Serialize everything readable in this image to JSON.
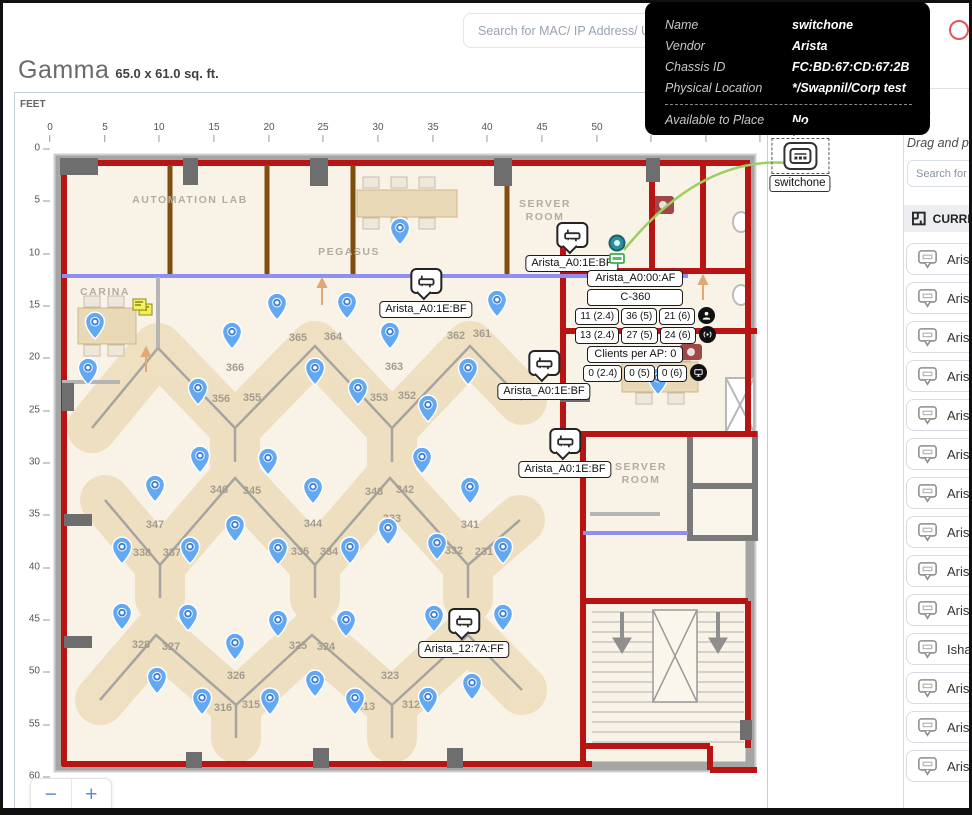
{
  "search": {
    "placeholder": "Search for MAC/ IP Address/ User"
  },
  "tooltip": {
    "rows": [
      {
        "label": "Name",
        "value": "switchone"
      },
      {
        "label": "Vendor",
        "value": "Arista"
      },
      {
        "label": "Chassis ID",
        "value": "FC:BD:67:CD:67:2B"
      },
      {
        "label": "Physical Location",
        "value": "*/Swapnil/Corp test"
      }
    ],
    "footer": {
      "label": "Available to Place",
      "value": "No"
    }
  },
  "header": {
    "title": "Gamma",
    "dimensions": "65.0 x 61.0 sq. ft."
  },
  "map": {
    "unit_label": "FEET",
    "zoom_out": "−",
    "zoom_in": "+",
    "x_ticks": [
      {
        "t": "0",
        "x": 50
      },
      {
        "t": "5",
        "x": 105
      },
      {
        "t": "10",
        "x": 159
      },
      {
        "t": "15",
        "x": 214
      },
      {
        "t": "20",
        "x": 269
      },
      {
        "t": "25",
        "x": 323
      },
      {
        "t": "30",
        "x": 378
      },
      {
        "t": "35",
        "x": 433
      },
      {
        "t": "40",
        "x": 487
      },
      {
        "t": "45",
        "x": 542
      },
      {
        "t": "50",
        "x": 597
      },
      {
        "t": "55",
        "x": 651
      },
      {
        "t": "60",
        "x": 706
      },
      {
        "t": "65",
        "x": 760
      }
    ],
    "y_ticks": [
      {
        "t": "0",
        "y": 148
      },
      {
        "t": "5",
        "y": 200
      },
      {
        "t": "10",
        "y": 253
      },
      {
        "t": "15",
        "y": 305
      },
      {
        "t": "20",
        "y": 357
      },
      {
        "t": "25",
        "y": 410
      },
      {
        "t": "30",
        "y": 462
      },
      {
        "t": "35",
        "y": 514
      },
      {
        "t": "40",
        "y": 567
      },
      {
        "t": "45",
        "y": 619
      },
      {
        "t": "50",
        "y": 671
      },
      {
        "t": "55",
        "y": 724
      },
      {
        "t": "60",
        "y": 776
      }
    ]
  },
  "floorplan": {
    "rooms": [
      {
        "name": "AUTOMATION LAB",
        "x": 190,
        "y": 200
      },
      {
        "name": "PEGASUS",
        "x": 349,
        "y": 252
      },
      {
        "name": "SERVER ROOM",
        "x": 545,
        "y": 211,
        "stack": true
      },
      {
        "name": "CARINA",
        "x": 105,
        "y": 292
      },
      {
        "name": "SERVER ROOM",
        "x": 641,
        "y": 474,
        "stack": true
      }
    ],
    "desks": [
      {
        "n": "365",
        "x": 298,
        "y": 338
      },
      {
        "n": "364",
        "x": 333,
        "y": 337
      },
      {
        "n": "366",
        "x": 235,
        "y": 368
      },
      {
        "n": "356",
        "x": 221,
        "y": 399
      },
      {
        "n": "355",
        "x": 252,
        "y": 398
      },
      {
        "n": "363",
        "x": 394,
        "y": 367
      },
      {
        "n": "353",
        "x": 379,
        "y": 398
      },
      {
        "n": "352",
        "x": 407,
        "y": 396
      },
      {
        "n": "362",
        "x": 456,
        "y": 336
      },
      {
        "n": "361",
        "x": 482,
        "y": 334
      },
      {
        "n": "346",
        "x": 219,
        "y": 490
      },
      {
        "n": "345",
        "x": 252,
        "y": 491
      },
      {
        "n": "347",
        "x": 155,
        "y": 525
      },
      {
        "n": "338",
        "x": 142,
        "y": 553
      },
      {
        "n": "337",
        "x": 172,
        "y": 553
      },
      {
        "n": "344",
        "x": 313,
        "y": 524
      },
      {
        "n": "335",
        "x": 300,
        "y": 552
      },
      {
        "n": "334",
        "x": 329,
        "y": 552
      },
      {
        "n": "343",
        "x": 374,
        "y": 492
      },
      {
        "n": "342",
        "x": 405,
        "y": 490
      },
      {
        "n": "333",
        "x": 392,
        "y": 519
      },
      {
        "n": "341",
        "x": 470,
        "y": 525
      },
      {
        "n": "332",
        "x": 454,
        "y": 551
      },
      {
        "n": "231",
        "x": 484,
        "y": 552
      },
      {
        "n": "328",
        "x": 141,
        "y": 645
      },
      {
        "n": "327",
        "x": 171,
        "y": 647
      },
      {
        "n": "326",
        "x": 236,
        "y": 676
      },
      {
        "n": "325",
        "x": 298,
        "y": 646
      },
      {
        "n": "324",
        "x": 326,
        "y": 647
      },
      {
        "n": "316",
        "x": 223,
        "y": 708
      },
      {
        "n": "315",
        "x": 251,
        "y": 705
      },
      {
        "n": "323",
        "x": 390,
        "y": 676
      },
      {
        "n": "313",
        "x": 366,
        "y": 707
      },
      {
        "n": "312",
        "x": 411,
        "y": 705
      }
    ],
    "pins": [
      {
        "x": 400,
        "y": 228
      },
      {
        "x": 95,
        "y": 322
      },
      {
        "x": 277,
        "y": 303
      },
      {
        "x": 347,
        "y": 302
      },
      {
        "x": 497,
        "y": 300
      },
      {
        "x": 232,
        "y": 332
      },
      {
        "x": 390,
        "y": 332
      },
      {
        "x": 88,
        "y": 368
      },
      {
        "x": 315,
        "y": 368
      },
      {
        "x": 468,
        "y": 368
      },
      {
        "x": 198,
        "y": 388
      },
      {
        "x": 358,
        "y": 388
      },
      {
        "x": 428,
        "y": 405
      },
      {
        "x": 200,
        "y": 456
      },
      {
        "x": 268,
        "y": 458
      },
      {
        "x": 422,
        "y": 457
      },
      {
        "x": 155,
        "y": 485
      },
      {
        "x": 313,
        "y": 487
      },
      {
        "x": 470,
        "y": 487
      },
      {
        "x": 235,
        "y": 525
      },
      {
        "x": 388,
        "y": 528
      },
      {
        "x": 437,
        "y": 543
      },
      {
        "x": 122,
        "y": 547
      },
      {
        "x": 190,
        "y": 547
      },
      {
        "x": 278,
        "y": 548
      },
      {
        "x": 350,
        "y": 547
      },
      {
        "x": 503,
        "y": 547
      },
      {
        "x": 122,
        "y": 613
      },
      {
        "x": 188,
        "y": 614
      },
      {
        "x": 278,
        "y": 620
      },
      {
        "x": 346,
        "y": 620
      },
      {
        "x": 434,
        "y": 615
      },
      {
        "x": 503,
        "y": 614
      },
      {
        "x": 235,
        "y": 643
      },
      {
        "x": 157,
        "y": 677
      },
      {
        "x": 315,
        "y": 680
      },
      {
        "x": 472,
        "y": 683
      },
      {
        "x": 202,
        "y": 698
      },
      {
        "x": 270,
        "y": 698
      },
      {
        "x": 355,
        "y": 698
      },
      {
        "x": 428,
        "y": 697
      },
      {
        "x": 658,
        "y": 378
      }
    ],
    "aps": [
      {
        "label": "Arista_A0:1E:BF",
        "x": 572,
        "y": 222
      },
      {
        "label": "Arista_A0:1E:BF",
        "x": 426,
        "y": 268
      },
      {
        "label": "Arista_A0:1E:BF",
        "x": 544,
        "y": 350
      },
      {
        "label": "Arista_A0:1E:BF",
        "x": 565,
        "y": 428
      },
      {
        "label": "Arista_12:7A:FF",
        "x": 464,
        "y": 608
      }
    ],
    "selected_ap": {
      "name": "Arista_A0:00:AF",
      "model": "C-360",
      "neighbors_row": [
        "11 (2.4)",
        "36 (5)",
        "21 (6)"
      ],
      "radios_row": [
        "13 (2.4)",
        "27 (5)",
        "24 (6)"
      ],
      "clients_label": "Clients per AP: 0",
      "clients_row": [
        "0 (2.4)",
        "0 (5)",
        "0 (6)"
      ]
    },
    "switch": {
      "label": "switchone"
    }
  },
  "sidebar": {
    "tab_fragment": "cces",
    "drag_hint": "Drag and pl",
    "search_placeholder": "Search for M",
    "section_header": "CURREN",
    "items": [
      {
        "label": "Aris"
      },
      {
        "label": "Aris"
      },
      {
        "label": "Aris"
      },
      {
        "label": "Aris"
      },
      {
        "label": "Aris"
      },
      {
        "label": "Aris"
      },
      {
        "label": "Aris"
      },
      {
        "label": "Aris"
      },
      {
        "label": "Aris"
      },
      {
        "label": "Aris"
      },
      {
        "label": "Isha"
      },
      {
        "label": "Aris"
      },
      {
        "label": "Aris"
      },
      {
        "label": "Aris"
      }
    ]
  },
  "colors": {
    "wall_red": "#b91414",
    "wall_blue": "#8f8ff2",
    "wall_brown": "#7d4e10",
    "pin_blue": "#63a8f2",
    "link_green": "#9ccf5f",
    "tooltip_bg": "#000000"
  }
}
